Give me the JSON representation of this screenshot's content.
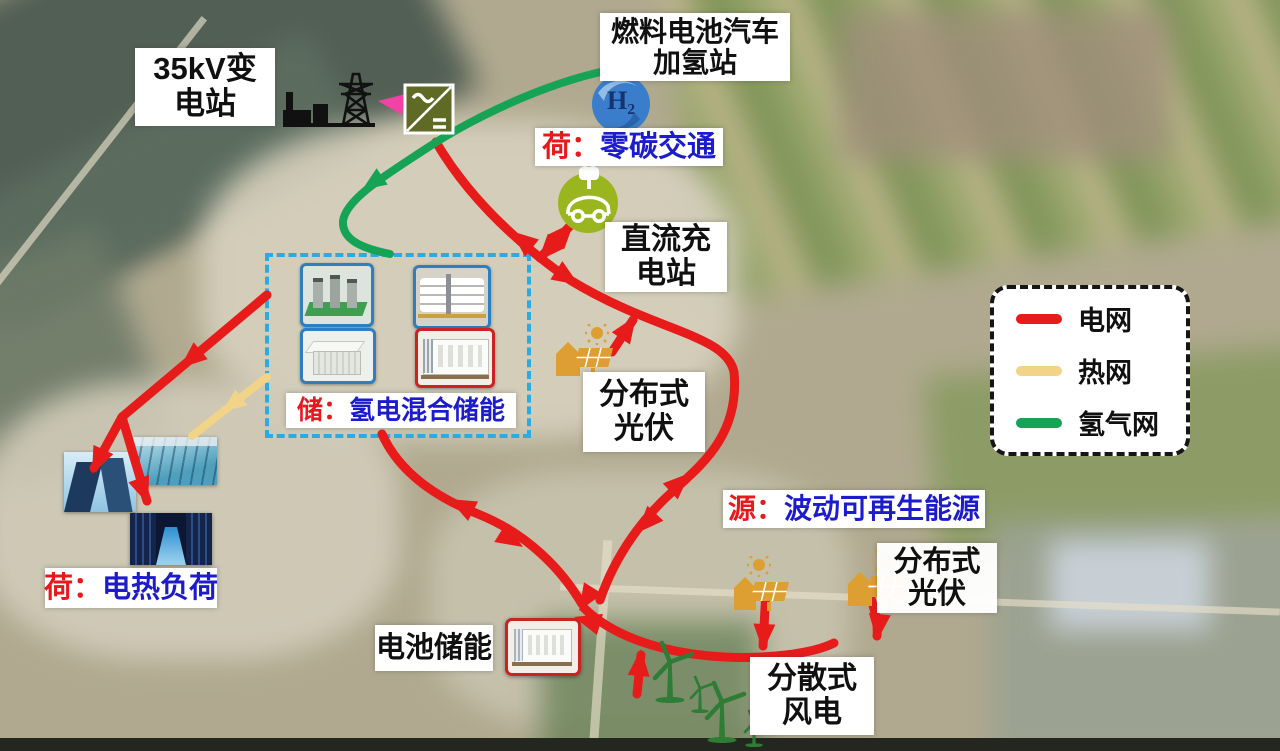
{
  "colors": {
    "grid_red": "#e81b1b",
    "heat_yellow": "#f2d488",
    "hydrogen_green": "#17a356",
    "converter_olive": "#5f6b24",
    "pink_arrow": "#f043a5",
    "label_blue": "#1c1ccc",
    "label_red": "#e8191c",
    "storage_box_border": "#2aabe4",
    "pv_orange": "#dd9e32",
    "wind_green": "#2e7c35",
    "ev_green": "#9ab61e",
    "h2_blue": "#3a7ecb"
  },
  "legend": {
    "items": [
      {
        "label": "电网",
        "color": "#e81b1b"
      },
      {
        "label": "热网",
        "color": "#f2d488"
      },
      {
        "label": "氢气网",
        "color": "#17a356"
      }
    ]
  },
  "labels": {
    "substation_l1": "35kV变",
    "substation_l2": "电站",
    "fuel_l1": "燃料电池汽车",
    "fuel_l2": "加氢站",
    "zero_prefix": "荷：",
    "zero_text": "零碳交通",
    "dc_l1": "直流充",
    "dc_l2": "电站",
    "storage_prefix": "储：",
    "storage_text": "氢电混合储能",
    "pv_mid_l1": "分布式",
    "pv_mid_l2": "光伏",
    "source_prefix": "源：",
    "source_text": "波动可再生能源",
    "pv_right_l1": "分布式",
    "pv_right_l2": "光伏",
    "heat_prefix": "荷：",
    "heat_text": "电热负荷",
    "battery_text": "电池储能",
    "wind_l1": "分散式",
    "wind_l2": "风电",
    "h2_symbol": "H₂"
  }
}
